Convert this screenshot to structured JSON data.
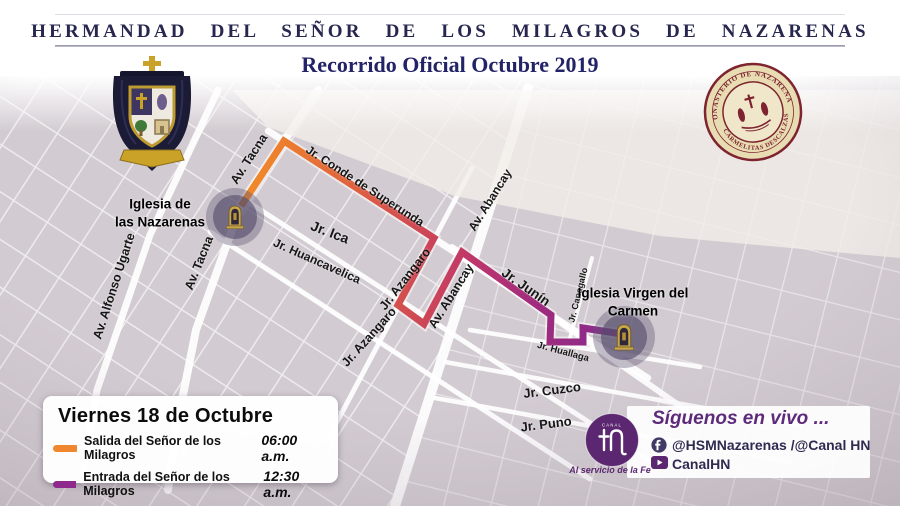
{
  "header": {
    "title": "HERMANDAD DEL SEÑOR DE LOS MILAGROS DE NAZARENAS",
    "subtitle": "Recorrido Oficial Octubre 2019"
  },
  "emblems": {
    "crest_icon": "hermandad-coat-of-arms",
    "seal_icon": "monasterio-seal",
    "seal_top": "MONASTERIO DE NAZARENAS",
    "seal_bottom": "CARMELITAS DESCALZAS"
  },
  "map": {
    "streets": [
      "Av. Tacna",
      "Av. Tacna",
      "Av. Alfonso Ugarte",
      "Jr. Conde de Superunda",
      "Jr. Ica",
      "Jr. Huancavelica",
      "Jr. Azangaro",
      "Jr. Azangaro",
      "Av. Abancay",
      "Av. Abancay",
      "Jr. Junín",
      "Jr. Canagallo",
      "Jr. Huallaga",
      "Jr. Cuzco",
      "Jr. Puno"
    ],
    "churches": [
      "Iglesia de\nlas Nazarenas",
      "Iglesia Virgen del\nCarmen"
    ]
  },
  "route": {
    "gradient": [
      "#F08D2C",
      "#EC7E2E",
      "#DE6040",
      "#D04B52",
      "#C53D62",
      "#B83470",
      "#A02B7E",
      "#842B8E"
    ]
  },
  "legend": {
    "title": "Viernes 18 de Octubre",
    "items": [
      {
        "label": "Salida del Señor de los Milagros",
        "time": "06:00 a.m.",
        "color": "#F0862D"
      },
      {
        "label": "Entrada del Señor de los Milagros",
        "time": "12:30 a.m.",
        "color": "#8E2A8B"
      }
    ]
  },
  "social": {
    "heading": "Síguenos en vivo ...",
    "facebook_icon": "facebook-icon",
    "facebook_handle": "@HSMNazarenas /@Canal HN",
    "youtube_icon": "youtube-icon",
    "youtube_handle": "CanalHN",
    "logo_top": "CANAL",
    "logo_tagline": "Al servicio de la Fe"
  }
}
